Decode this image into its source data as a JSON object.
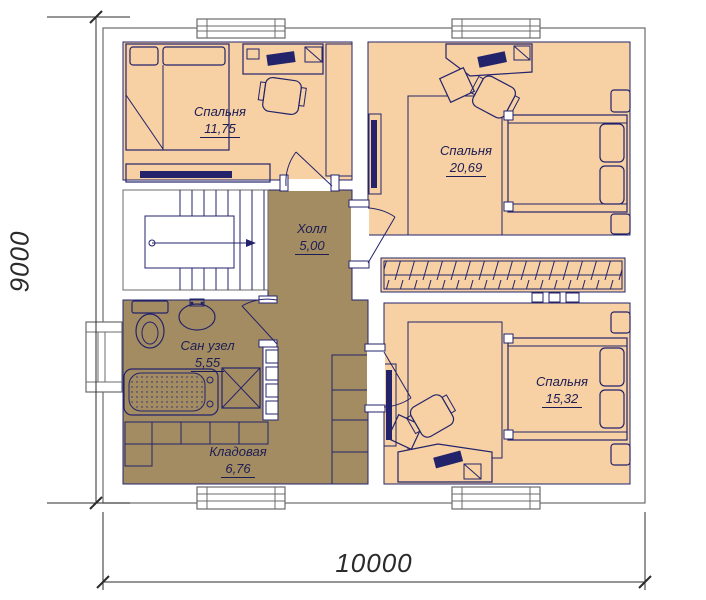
{
  "document": {
    "type": "floor-plan",
    "floor_note": "second floor plan"
  },
  "colors": {
    "room_fill": "#f7d0a3",
    "wet_zone_fill": "#a38c62",
    "line": "#23236b",
    "wall_outline": "#6b6b6b",
    "dim": "#2b2b2b",
    "text": "#1d1d55",
    "background": "#ffffff"
  },
  "rooms": [
    {
      "id": "bedroom-tl",
      "name": "Спальня",
      "area": "11,75"
    },
    {
      "id": "bedroom-tr",
      "name": "Спальня",
      "area": "20,69"
    },
    {
      "id": "hall",
      "name": "Холл",
      "area": "5,00"
    },
    {
      "id": "bathroom",
      "name": "Сан узел",
      "area": "5,55"
    },
    {
      "id": "storage",
      "name": "Кладовая",
      "area": "6,76"
    },
    {
      "id": "bedroom-br",
      "name": "Спальня",
      "area": "15,32"
    }
  ],
  "dimensions": {
    "bottom_width": "10000",
    "left_height": "9000"
  }
}
